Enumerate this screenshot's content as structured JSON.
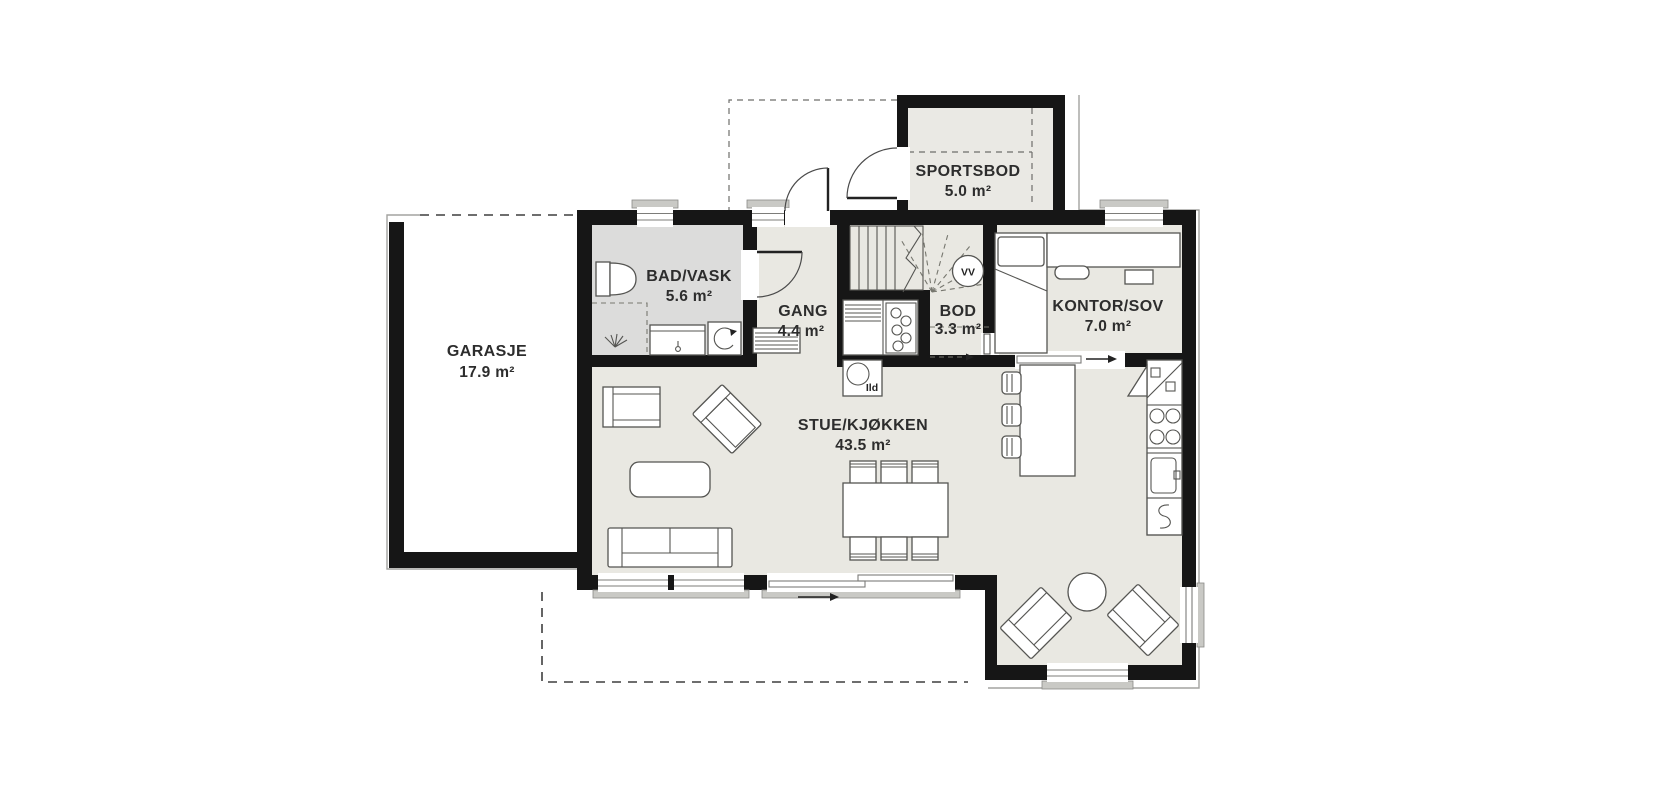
{
  "plan": {
    "rooms": [
      {
        "id": "garasje",
        "name": "GARASJE",
        "area": "17.9 m²"
      },
      {
        "id": "bad-vask",
        "name": "BAD/VASK",
        "area": "5.6 m²"
      },
      {
        "id": "gang",
        "name": "GANG",
        "area": "4.4 m²"
      },
      {
        "id": "sportsbod",
        "name": "SPORTSBOD",
        "area": "5.0 m²"
      },
      {
        "id": "bod",
        "name": "BOD",
        "area": "3.3 m²"
      },
      {
        "id": "kontor-sov",
        "name": "KONTOR/SOV",
        "area": "7.0 m²"
      },
      {
        "id": "stue-kjokken",
        "name": "STUE/KJØKKEN",
        "area": "43.5 m²"
      }
    ],
    "annotations": {
      "water_heater_label": "VV",
      "fireplace_label": "Ild"
    },
    "colors": {
      "wall": "#161616",
      "floor": "#e9e8e2",
      "floor-bad": "#dcdcdb",
      "floor-sportsbod": "#eae9e4",
      "line": "#555552",
      "thin": "#a3a3a0",
      "sill": "#c9c9c5",
      "text": "#2d2d2d"
    }
  }
}
